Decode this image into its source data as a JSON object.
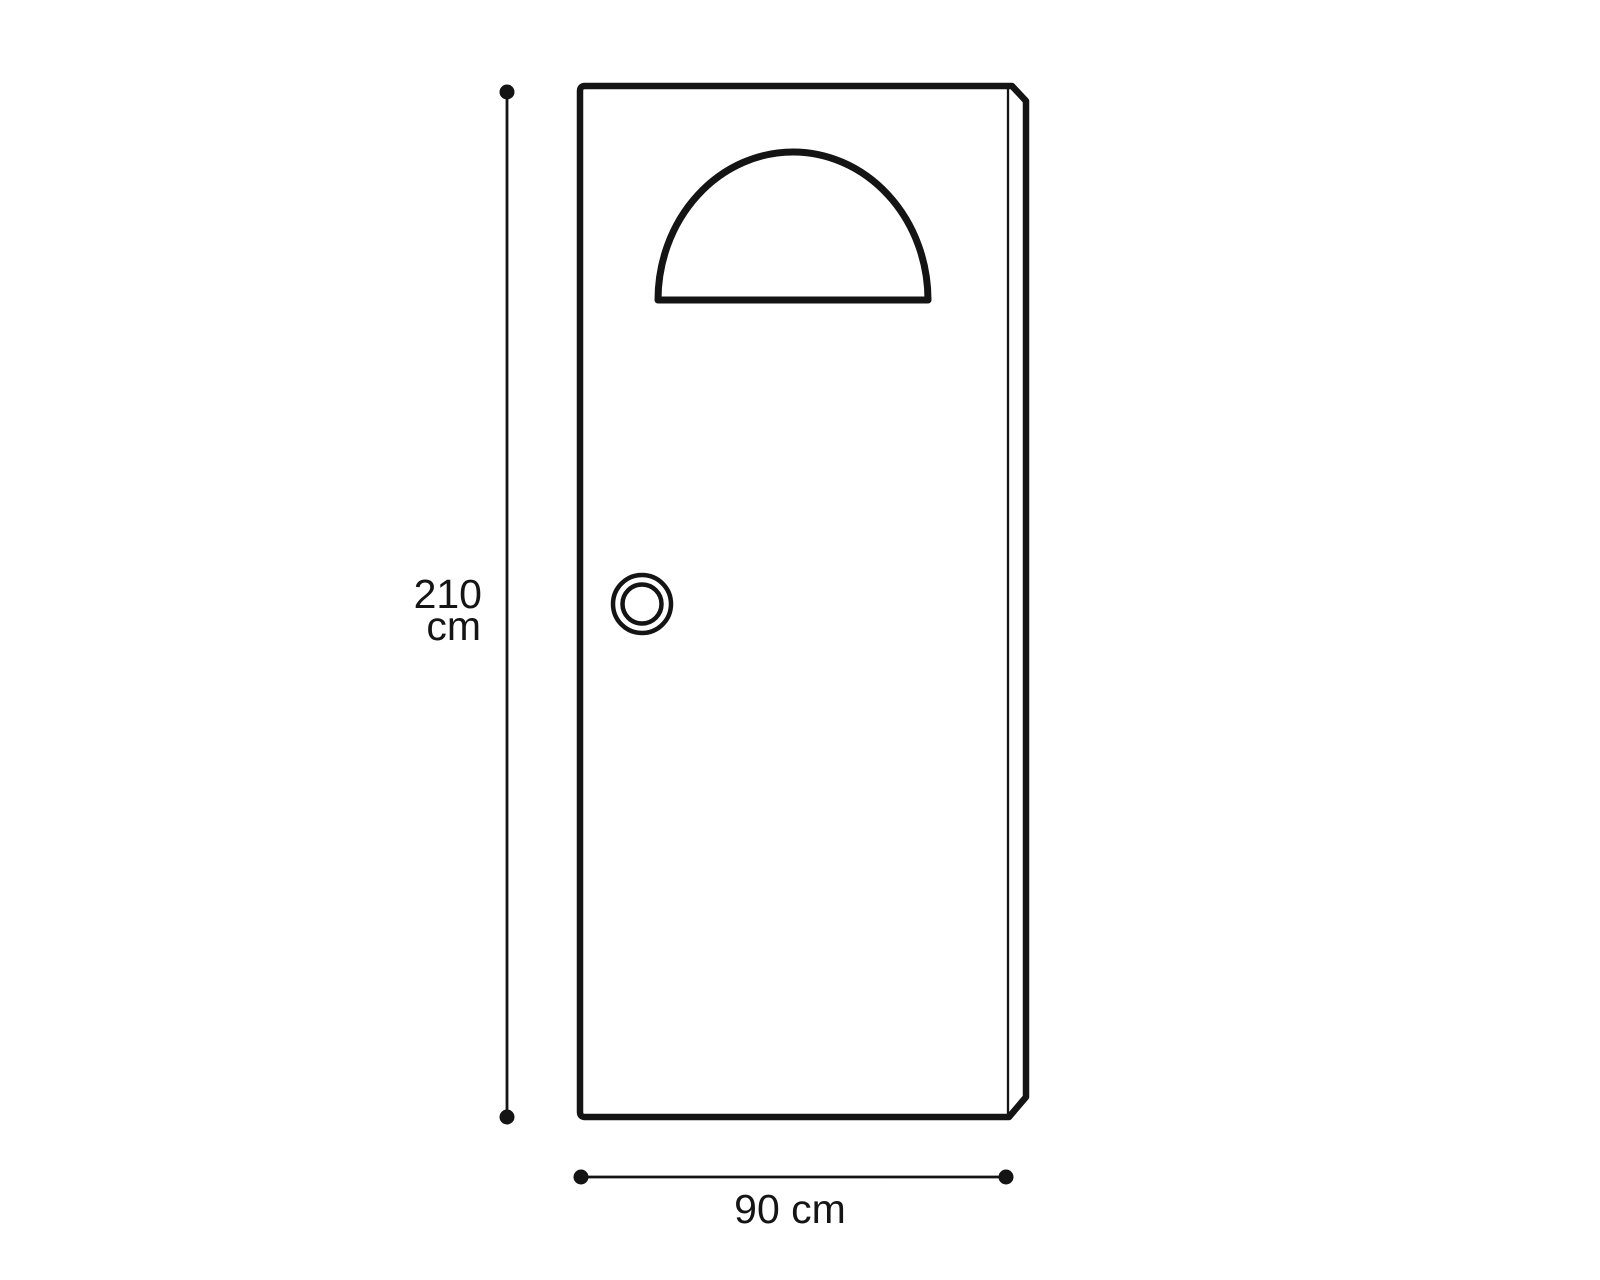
{
  "colors": {
    "background": "#ffffff",
    "line": "#141414",
    "text": "#151515"
  },
  "figure": {
    "type": "door-dimension-diagram",
    "height_dimension": {
      "label_lines": [
        "210",
        "cm"
      ],
      "value_cm": 210
    },
    "width_dimension": {
      "label": "90 cm",
      "value_cm": 90
    },
    "elements": [
      "door-outline",
      "door-front-edge",
      "arched-window",
      "doorknob",
      "height-dimension-line",
      "width-dimension-line"
    ]
  }
}
